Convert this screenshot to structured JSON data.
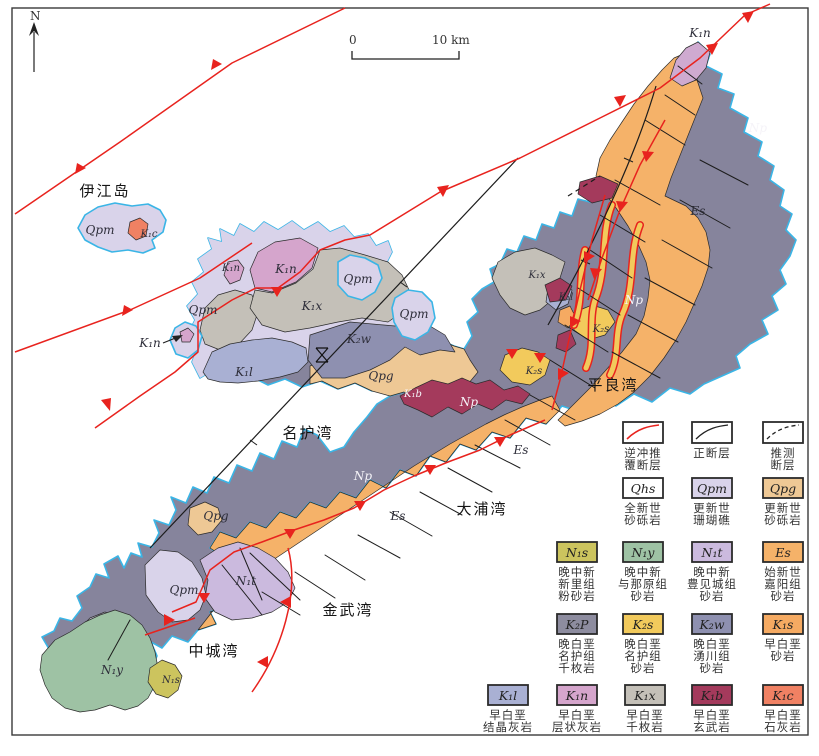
{
  "title": "冲绳岛北部地质图",
  "north": {
    "label": "N"
  },
  "scale": {
    "zero": "0",
    "ten": "10 km"
  },
  "colors": {
    "coastline": "#3ab5e6",
    "thrust_fault": "#e8231e",
    "normal_fault": "#1c1c1c",
    "np_bedrock": "#86849c",
    "sea": "#ffffff"
  },
  "map": {
    "labels": [
      {
        "text": "伊江岛"
      },
      {
        "text": "Qpm"
      },
      {
        "text": "K₁c"
      },
      {
        "text": "K₁n"
      },
      {
        "text": "Np"
      },
      {
        "text": "Es"
      },
      {
        "text": "Np"
      },
      {
        "text": "K₂s"
      },
      {
        "text": "K₁x"
      },
      {
        "text": "K₁l"
      },
      {
        "text": "K₁n"
      },
      {
        "text": "K₁x"
      },
      {
        "text": "Qpm"
      },
      {
        "text": "Qpm"
      },
      {
        "text": "Qpm"
      },
      {
        "text": "K₁n"
      },
      {
        "text": "K₂w"
      },
      {
        "text": "K₁l"
      },
      {
        "text": "Qpg"
      },
      {
        "text": "K₁b"
      },
      {
        "text": "K₂s"
      },
      {
        "text": "平良湾"
      },
      {
        "text": "名护湾"
      },
      {
        "text": "Np"
      },
      {
        "text": "Es"
      },
      {
        "text": "Np"
      },
      {
        "text": "Es"
      },
      {
        "text": "大浦湾"
      },
      {
        "text": "Qpg"
      },
      {
        "text": "Qpm"
      },
      {
        "text": "N₁t"
      },
      {
        "text": "金武湾"
      },
      {
        "text": "中城湾"
      },
      {
        "text": "N₁y"
      },
      {
        "text": "N₁s"
      },
      {
        "text": "K₁n"
      }
    ]
  },
  "legend": {
    "faults": [
      {
        "style": "thrust",
        "lines": [
          "逆冲推",
          "覆断层"
        ]
      },
      {
        "style": "normal",
        "lines": [
          "正断层",
          ""
        ]
      },
      {
        "style": "inferred",
        "lines": [
          "推测",
          "断层"
        ]
      }
    ],
    "units": [
      {
        "symbol": "Qhs",
        "color": "#ffffff",
        "lines": [
          "全新世",
          "砂砾岩",
          ""
        ]
      },
      {
        "symbol": "Qpm",
        "color": "#d9d3ea",
        "lines": [
          "更新世",
          "珊瑚礁",
          ""
        ]
      },
      {
        "symbol": "Qpg",
        "color": "#eec895",
        "lines": [
          "更新世",
          "砂砾岩",
          ""
        ]
      },
      {
        "symbol": "N₁s",
        "color": "#ccc45e",
        "lines": [
          "晚中新",
          "新里组",
          "粉砂岩"
        ]
      },
      {
        "symbol": "N₁y",
        "color": "#9ec2a4",
        "lines": [
          "晚中新",
          "与那原组",
          "砂岩"
        ]
      },
      {
        "symbol": "N₁t",
        "color": "#cbbade",
        "lines": [
          "晚中新",
          "豊见城组",
          "砂岩"
        ]
      },
      {
        "symbol": "Es",
        "color": "#f5b269",
        "lines": [
          "始新世",
          "嘉阳组",
          "砂岩"
        ]
      },
      {
        "symbol": "K₂P",
        "color": "#8d8c9f",
        "lines": [
          "晚白垩",
          "名护组",
          "千枚岩"
        ]
      },
      {
        "symbol": "K₂s",
        "color": "#f2ca5c",
        "lines": [
          "晚白垩",
          "名护组",
          "砂岩"
        ]
      },
      {
        "symbol": "K₂w",
        "color": "#8e90b0",
        "lines": [
          "晚白垩",
          "湧川组",
          "砂岩"
        ]
      },
      {
        "symbol": "K₁s",
        "color": "#f5aa62",
        "lines": [
          "早白垩",
          "砂岩",
          ""
        ]
      },
      {
        "symbol": "K₁l",
        "color": "#a9b0d3",
        "lines": [
          "早白垩",
          "结晶灰岩",
          ""
        ]
      },
      {
        "symbol": "K₁n",
        "color": "#d5a5cc",
        "lines": [
          "早白垩",
          "层状灰岩",
          ""
        ]
      },
      {
        "symbol": "K₁x",
        "color": "#c4c0b8",
        "lines": [
          "早白垩",
          "千枚岩",
          ""
        ]
      },
      {
        "symbol": "K₁b",
        "color": "#a43a5c",
        "lines": [
          "早白垩",
          "玄武岩",
          ""
        ]
      },
      {
        "symbol": "K₁c",
        "color": "#f08163",
        "lines": [
          "早白垩",
          "石灰岩",
          ""
        ]
      }
    ]
  }
}
